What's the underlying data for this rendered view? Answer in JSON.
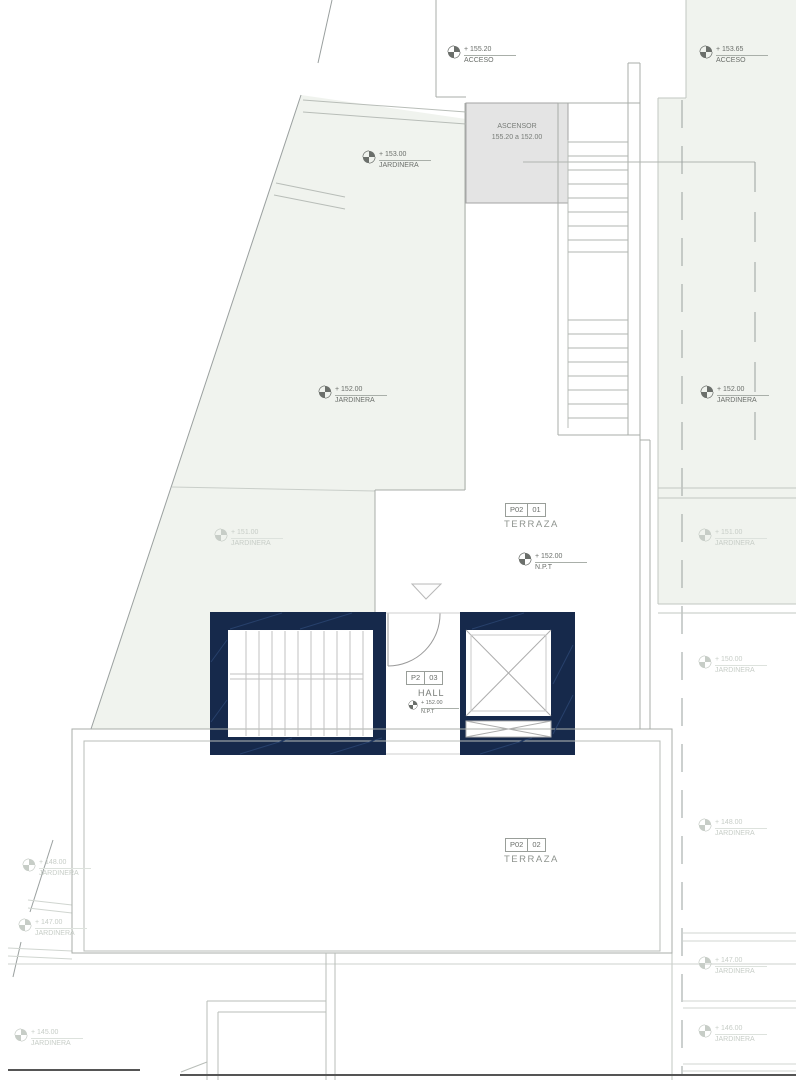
{
  "drawing": {
    "elevator": {
      "label": "ASCENSOR",
      "range": "155.20 a 152.00"
    },
    "zones": {
      "terraza01": {
        "code": "P02",
        "num": "01",
        "name": "TERRAZA"
      },
      "terraza02": {
        "code": "P02",
        "num": "02",
        "name": "TERRAZA"
      },
      "hall": {
        "code": "P2",
        "num": "03",
        "name": "HALL"
      }
    },
    "levels": {
      "acceso_left": {
        "elev": "+ 155.20",
        "label": "ACCESO"
      },
      "acceso_right": {
        "elev": "+ 153.65",
        "label": "ACCESO"
      },
      "jard_153": {
        "elev": "+ 153.00",
        "label": "JARDINERA"
      },
      "jard_152_left": {
        "elev": "+ 152.00",
        "label": "JARDINERA"
      },
      "jard_152_right": {
        "elev": "+ 152.00",
        "label": "JARDINERA"
      },
      "npt_terraza": {
        "elev": "+ 152.00",
        "label": "N.P.T"
      },
      "npt_hall": {
        "elev": "+ 152.00",
        "label": "N.P.T"
      },
      "jard_151_left": {
        "elev": "+ 151.00",
        "label": "JARDINERA"
      },
      "jard_151_right": {
        "elev": "+ 151.00",
        "label": "JARDINERA"
      },
      "jard_150_right": {
        "elev": "+ 150.00",
        "label": "JARDINERA"
      },
      "jard_148_right": {
        "elev": "+ 148.00",
        "label": "JARDINERA"
      },
      "jard_147_right": {
        "elev": "+ 147.00",
        "label": "JARDINERA"
      },
      "jard_146_right": {
        "elev": "+ 146.00",
        "label": "JARDINERA"
      },
      "jard_148_left": {
        "elev": "+ 148.00",
        "label": "JARDINERA"
      },
      "jard_147_left": {
        "elev": "+ 147.00",
        "label": "JARDINERA"
      },
      "jard_145_left": {
        "elev": "+ 145.00",
        "label": "JARDINERA"
      }
    },
    "colors": {
      "navy": "#16294b",
      "tint": "#f0f3ee",
      "elevator_fill": "#e4e4e4"
    }
  }
}
